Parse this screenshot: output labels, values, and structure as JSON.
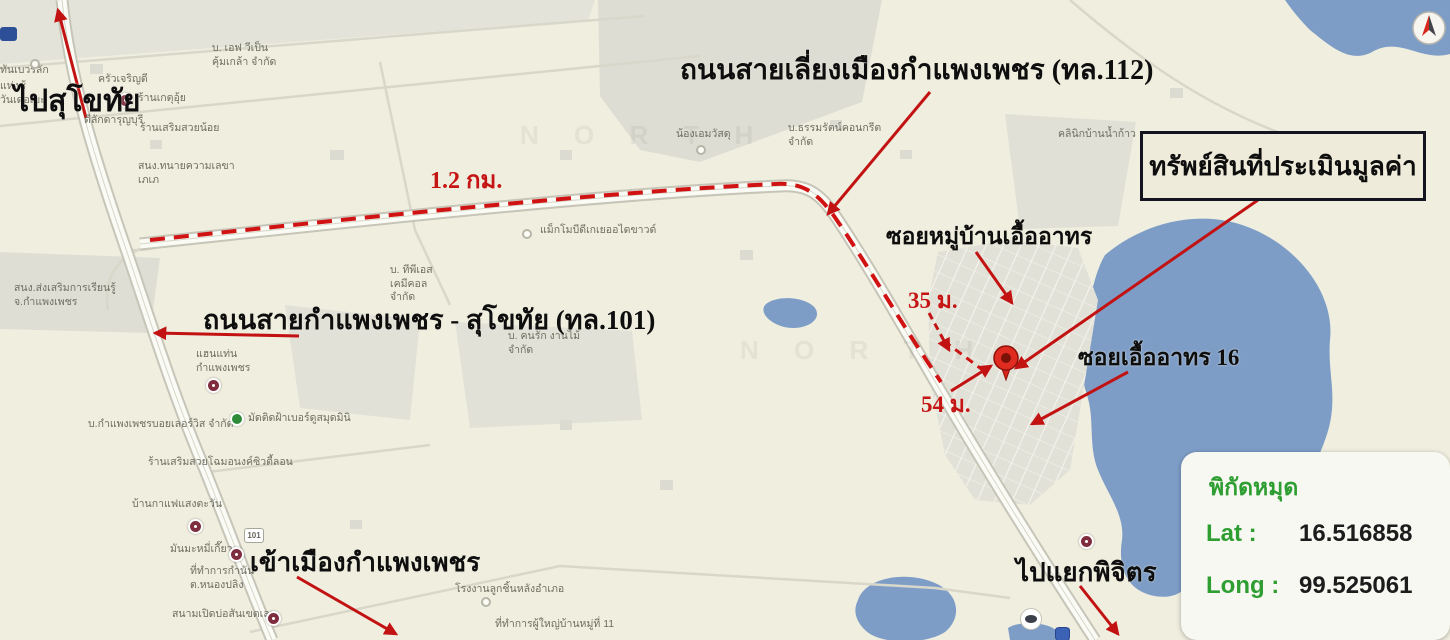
{
  "annotations": {
    "bypass_road": "ถนนสายเลี่ยงเมืองกำแพงเพชร (ทล.112)",
    "road_101": "ถนนสายกำแพงเพชร - สุโขทัย (ทล.101)",
    "to_sukhothai": "ไปสุโขทัย",
    "to_city": "เข้าเมืองกำแพงเพชร",
    "to_phichit": "ไปแยกพิจิตร",
    "soi_mu_ban": "ซอยหมู่บ้านเอื้ออาทร",
    "soi_16": "ซอยเอื้ออาทร 16",
    "distance_main": "1.2 กม.",
    "distance_35": "35 ม.",
    "distance_54": "54 ม.",
    "property_box": "ทรัพย์สินที่ประเมินมูลค่า"
  },
  "coordinates_panel": {
    "title": "พิกัดหมุด",
    "lat_label": "Lat :",
    "lat_value": "16.516858",
    "long_label": "Long :",
    "long_value": "99.525061"
  },
  "colors": {
    "map_background": "#efeedf",
    "water": "#7d9dc7",
    "annotation_red": "#c51414",
    "panel_green": "#2f9e32",
    "box_border": "#141420"
  },
  "map": {
    "pois": [
      {
        "text": "บ. เอฟ วีเป็น\nคุ้มเกล้า จำกัด",
        "x": 212,
        "y": 42
      },
      {
        "text": "ครัวเจริญดี",
        "x": 98,
        "y": 73
      },
      {
        "text": "ร้านเกตุอุ้ย",
        "x": 138,
        "y": 92
      },
      {
        "text": "ดีลักดารุญบุรี",
        "x": 84,
        "y": 114
      },
      {
        "text": "ร้านเสริมสวยน้อย",
        "x": 140,
        "y": 122
      },
      {
        "text": "สนง.ทนายความเลขา\nเภเภ",
        "x": 138,
        "y": 160
      },
      {
        "text": "ทันเบวริลัก",
        "x": 0,
        "y": 64
      },
      {
        "text": "แห่งช้\nวันเดอเบะ",
        "x": 0,
        "y": 80
      },
      {
        "text": "น้องเอมวัสดุ",
        "x": 676,
        "y": 128
      },
      {
        "text": "บ.ธรรมรัตน์คอนกรีต\nจำกัด",
        "x": 788,
        "y": 122
      },
      {
        "text": "คลินิกบ้านน้ำก้าว",
        "x": 1058,
        "y": 128
      },
      {
        "text": "แม็กโมบีดีเกเยออไดขาวด์",
        "x": 540,
        "y": 224
      },
      {
        "text": "บ. ทีพีเอส\nเคมีคอล\nจำกัด",
        "x": 390,
        "y": 264
      },
      {
        "text": "บ. คนรัก งานไม้\nจำกัด",
        "x": 508,
        "y": 330
      },
      {
        "text": "สนง.ส่งเสริมการเรียนรู้\nจ.กำแพงเพชร",
        "x": 14,
        "y": 282
      },
      {
        "text": "แฮนแท่น\nกำแพงเพชร",
        "x": 196,
        "y": 348
      },
      {
        "text": "บ.กำแพงเพชรบอยเลอร์วิส จำกัด",
        "x": 88,
        "y": 418
      },
      {
        "text": "มัดติดฝ้าเบอร์ดูสมุดมินิ",
        "x": 248,
        "y": 412
      },
      {
        "text": "ร้านเสริมสวยโฉมอนงค์ซิวตี้ลอน",
        "x": 148,
        "y": 456
      },
      {
        "text": "บ้านกาแฟแสงตะวัน",
        "x": 132,
        "y": 498
      },
      {
        "text": "มันมะหมี่เกี๊ยว",
        "x": 170,
        "y": 543
      },
      {
        "text": "ที่ทำการกำนัน\nต.หนองปลิง",
        "x": 190,
        "y": 565
      },
      {
        "text": "สนามเปิดบ่อสันเขตเลม",
        "x": 172,
        "y": 608
      },
      {
        "text": "โรงงานลูกชิ้นหลังอำเภอ",
        "x": 455,
        "y": 583
      },
      {
        "text": "ที่ทำการผู้ใหญ่บ้านหมู่ที่ 11",
        "x": 495,
        "y": 618
      }
    ],
    "icons": [
      {
        "type": "maroon-circle",
        "x": 118,
        "y": 93
      },
      {
        "type": "maroon-circle",
        "x": 206,
        "y": 378
      },
      {
        "type": "maroon-circle",
        "x": 188,
        "y": 519
      },
      {
        "type": "maroon-circle",
        "x": 229,
        "y": 547
      },
      {
        "type": "maroon-circle",
        "x": 266,
        "y": 611
      },
      {
        "type": "maroon-circle",
        "x": 1079,
        "y": 534
      },
      {
        "type": "white-dot",
        "x": 522,
        "y": 229
      },
      {
        "type": "white-dot",
        "x": 696,
        "y": 145
      },
      {
        "type": "white-dot",
        "x": 481,
        "y": 597
      },
      {
        "type": "white-dot",
        "x": 30,
        "y": 59
      },
      {
        "type": "green-circle",
        "x": 230,
        "y": 412
      },
      {
        "type": "route-shield",
        "x": 244,
        "y": 528,
        "label": "101"
      },
      {
        "type": "blue-tag",
        "x": 0,
        "y": 27
      },
      {
        "type": "white-oval",
        "x": 1020,
        "y": 608
      },
      {
        "type": "blue-shield",
        "x": 1055,
        "y": 627
      }
    ],
    "watermarks": [
      {
        "text": "N O R T H",
        "x": 520,
        "y": 120
      },
      {
        "text": "N O R T H",
        "x": 740,
        "y": 335
      }
    ]
  }
}
